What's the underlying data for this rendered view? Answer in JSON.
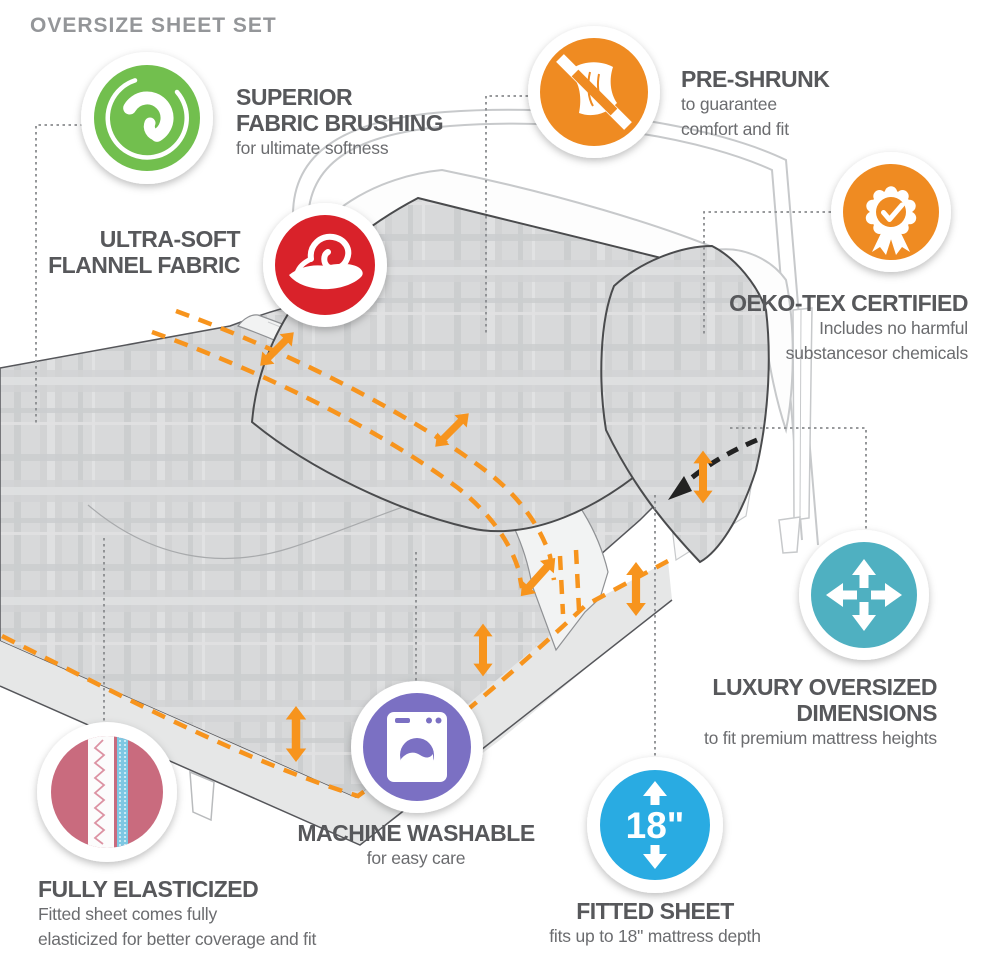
{
  "title": "OVERSIZE SHEET SET",
  "colors": {
    "green": "#72bf4e",
    "orange": "#ef8b22",
    "red": "#d9222a",
    "teal": "#4fb0c1",
    "purple": "#7b70c3",
    "blue": "#29abe2",
    "pink_fabric": "#c96b7e",
    "elastic_blue": "#7ec8e3",
    "dash_orange": "#f7941d",
    "heading_gray": "#57585b",
    "subtext_gray": "#6b6c6f",
    "title_gray": "#949699"
  },
  "features": [
    {
      "id": "superior-fabric-brushing",
      "icon": "swirl-icon",
      "line1": "SUPERIOR",
      "line2": "FABRIC BRUSHING",
      "sub1": "for ultimate softness"
    },
    {
      "id": "pre-shrunk",
      "icon": "no-shrink-cloth-icon",
      "line1": "PRE-SHRUNK",
      "sub1": "to guarantee",
      "sub2": "comfort and fit"
    },
    {
      "id": "ultra-soft-flannel",
      "icon": "hand-holding-fabric-icon",
      "line1": "ULTRA-SOFT",
      "line2": "FLANNEL FABRIC"
    },
    {
      "id": "oeko-tex-certified",
      "icon": "certified-ribbon-icon",
      "line1": "OEKO-TEX CERTIFIED",
      "sub1": "Includes no harmful",
      "sub2": "substancesor chemicals"
    },
    {
      "id": "luxury-oversized-dimensions",
      "icon": "expand-arrows-icon",
      "line1": "LUXURY OVERSIZED",
      "line2": "DIMENSIONS",
      "sub1": "to fit premium mattress heights"
    },
    {
      "id": "machine-washable",
      "icon": "washing-machine-icon",
      "line1": "MACHINE WASHABLE",
      "sub1": "for easy care"
    },
    {
      "id": "fitted-sheet",
      "icon": "mattress-depth-icon",
      "badge": "18\"",
      "line1": "FITTED SHEET",
      "sub1": "fits up to 18\" mattress depth"
    },
    {
      "id": "fully-elasticized",
      "icon": "elastic-closeup-icon",
      "line1": "FULLY ELASTICIZED",
      "sub1": "Fitted sheet comes fully",
      "sub2": "elasticized for better coverage and fit"
    }
  ]
}
